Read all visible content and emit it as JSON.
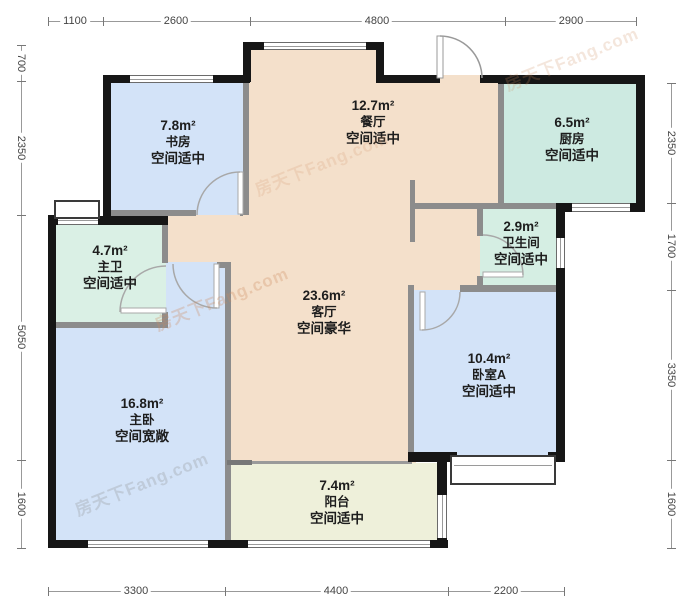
{
  "meta": {
    "type": "residential-floor-plan",
    "watermark": "房天下Fang.com"
  },
  "rooms": [
    {
      "id": "dining",
      "area": "12.7m²",
      "name": "餐厅",
      "quality": "空间适中"
    },
    {
      "id": "study",
      "area": "7.8m²",
      "name": "书房",
      "quality": "空间适中"
    },
    {
      "id": "kitchen",
      "area": "6.5m²",
      "name": "厨房",
      "quality": "空间适中"
    },
    {
      "id": "bathroom",
      "area": "2.9m²",
      "name": "卫生间",
      "quality": "空间适中"
    },
    {
      "id": "living",
      "area": "23.6m²",
      "name": "客厅",
      "quality": "空间豪华"
    },
    {
      "id": "bedroom-a",
      "area": "10.4m²",
      "name": "卧室A",
      "quality": "空间适中"
    },
    {
      "id": "master-bath",
      "area": "4.7m²",
      "name": "主卫",
      "quality": "空间适中"
    },
    {
      "id": "master-bedroom",
      "area": "16.8m²",
      "name": "主卧",
      "quality": "空间宽敞"
    },
    {
      "id": "balcony",
      "area": "7.4m²",
      "name": "阳台",
      "quality": "空间适中"
    }
  ],
  "dimensions": {
    "top": [
      "1100",
      "2600",
      "4800",
      "2900"
    ],
    "bottom": [
      "3300",
      "4400",
      "2200"
    ],
    "left": [
      "700",
      "2350",
      "5050",
      "1600"
    ],
    "right": [
      "2350",
      "1700",
      "3350",
      "1600"
    ]
  },
  "colors": {
    "wall": "#161616",
    "partition": "#8c8c8c",
    "room_blue": "#d3e3f8",
    "room_tan": "#f4e0cb",
    "room_teal": "#cdeae1",
    "room_bath_teal": "#d5eee3",
    "room_mint": "#daf0e5",
    "room_balcony": "#eef0da"
  }
}
